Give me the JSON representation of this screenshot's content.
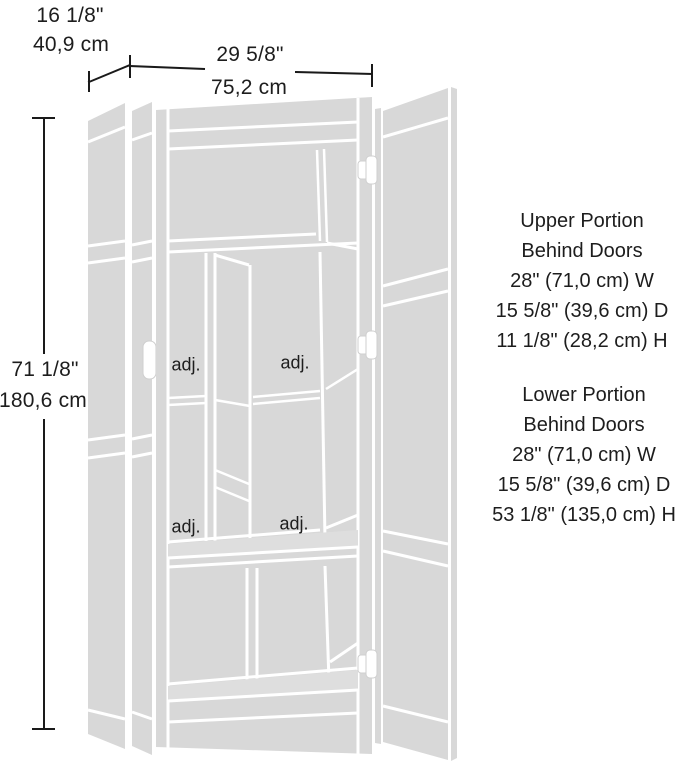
{
  "dimensions": {
    "door_width_imperial": "16 1/8\"",
    "door_width_metric": "40,9 cm",
    "overall_width_imperial": "29 5/8\"",
    "overall_width_metric": "75,2 cm",
    "overall_height_imperial": "71 1/8\"",
    "overall_height_metric": "180,6 cm"
  },
  "shelf_label": "adj.",
  "upper_portion": {
    "lines": [
      "Upper Portion",
      "Behind Doors",
      "28\" (71,0 cm) W",
      "15 5/8\" (39,6 cm) D",
      "11 1/8\" (28,2 cm) H"
    ]
  },
  "lower_portion": {
    "lines": [
      "Lower Portion",
      "Behind Doors",
      "28\" (71,0 cm) W",
      "15 5/8\" (39,6 cm) D",
      "53 1/8\" (135,0 cm) H"
    ]
  },
  "colors": {
    "line_art_fill": "#d8d8d8",
    "line_art_separator": "#ffffff",
    "dimension_line": "#1a1a1a",
    "text": "#1d1d1d",
    "background": "#ffffff"
  }
}
